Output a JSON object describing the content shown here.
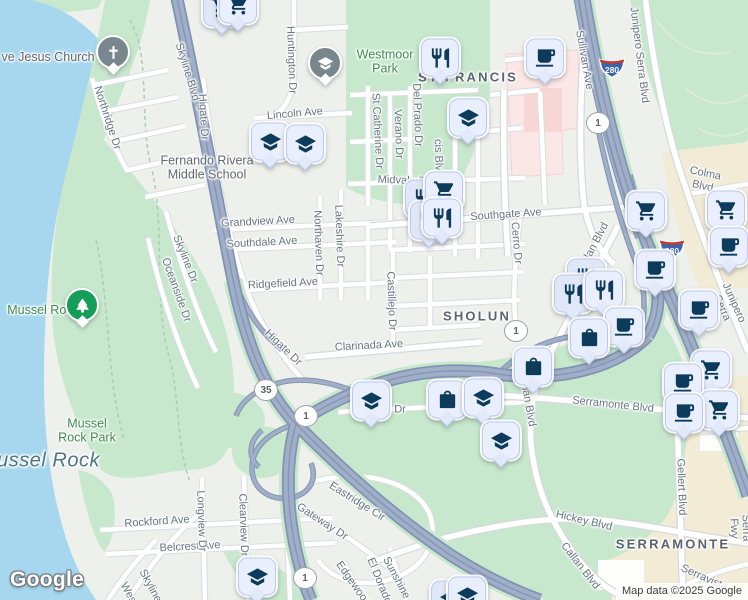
{
  "map": {
    "logo": "Google",
    "attribution": "Map data ©2025 Google",
    "colors": {
      "land": "#eef0ec",
      "water": "#a6d7ef",
      "park": "#c7e8cd",
      "beige": "#f2ecd7",
      "pink": "#fbe7e6",
      "road_fill": "#ffffff",
      "road_casing": "#dadce0",
      "freeway_fill": "#a1aec8",
      "freeway_casing": "#8093b3",
      "pin_bg": "#e9effc",
      "pin_border": "#bcc9ef",
      "pin_icon": "#0d3b5c",
      "circle_pin_gray": "#78868e",
      "circle_pin_green": "#149e57",
      "shield_blue": "#3a64ad",
      "shield_red": "#c63b31",
      "street_label": "#66757f",
      "area_label": "#5a646e",
      "park_label": "#3f8a52",
      "water_label": "#4e7585"
    },
    "labels": [
      {
        "name": "jesus-church",
        "text": "ve Jesus Church",
        "x": 48,
        "y": 57,
        "rot": 0,
        "type": "poi"
      },
      {
        "name": "northridge-dr",
        "text": "Northridge Dr",
        "x": 107,
        "y": 118,
        "rot": 72,
        "type": "street"
      },
      {
        "name": "skyline-blvd",
        "text": "Skyline Blvd",
        "x": 187,
        "y": 72,
        "rot": 73,
        "type": "street"
      },
      {
        "name": "higate-dr-north",
        "text": "Higate Dr",
        "x": 203,
        "y": 117,
        "rot": 87,
        "type": "street"
      },
      {
        "name": "huntington-dr",
        "text": "Huntington Dr",
        "x": 291,
        "y": 60,
        "rot": 88,
        "type": "street"
      },
      {
        "name": "lincoln-ave",
        "text": "Lincoln Ave",
        "x": 295,
        "y": 114,
        "rot": -5,
        "type": "street"
      },
      {
        "name": "fernando-rivera-middle-school",
        "text": "Fernando Rivera\nMiddle School",
        "x": 207,
        "y": 168,
        "rot": 0,
        "type": "poi"
      },
      {
        "name": "westmoor-park",
        "text": "Westmoor\nPark",
        "x": 385,
        "y": 62,
        "rot": 0,
        "type": "park"
      },
      {
        "name": "st-francis",
        "text": "ST FRANCIS",
        "x": 468,
        "y": 78,
        "rot": 0,
        "type": "area"
      },
      {
        "name": "st-catherine-dr",
        "text": "St Catherine Dr",
        "x": 377,
        "y": 131,
        "rot": 87,
        "type": "street"
      },
      {
        "name": "verano-dr",
        "text": "Verano Dr",
        "x": 398,
        "y": 134,
        "rot": 88,
        "type": "street"
      },
      {
        "name": "del-prado-dr",
        "text": "Del Prado Dr",
        "x": 417,
        "y": 115,
        "rot": 88,
        "type": "street"
      },
      {
        "name": "francis-blvd",
        "text": "cis Blvd",
        "x": 438,
        "y": 158,
        "rot": 88,
        "type": "street"
      },
      {
        "name": "sullivan-ave",
        "text": "Sullivan Ave",
        "x": 584,
        "y": 60,
        "rot": 80,
        "type": "street"
      },
      {
        "name": "junipero-serra-blvd-north",
        "text": "Junipero Serra Blvd",
        "x": 639,
        "y": 55,
        "rot": 83,
        "type": "street"
      },
      {
        "name": "colma-blvd",
        "text": "Colma Blvd",
        "x": 704,
        "y": 180,
        "rot": 12,
        "type": "street"
      },
      {
        "name": "midvale-dr",
        "text": "Midvale Dr",
        "x": 404,
        "y": 181,
        "rot": 2,
        "type": "street"
      },
      {
        "name": "grandview-ave",
        "text": "Grandview Ave",
        "x": 258,
        "y": 222,
        "rot": -3,
        "type": "street"
      },
      {
        "name": "southdale-ave",
        "text": "Southdale Ave",
        "x": 262,
        "y": 243,
        "rot": -3,
        "type": "street"
      },
      {
        "name": "northaven-dr",
        "text": "Northaven Dr",
        "x": 318,
        "y": 243,
        "rot": 88,
        "type": "street"
      },
      {
        "name": "lakeshire-dr",
        "text": "Lakeshire Dr",
        "x": 339,
        "y": 236,
        "rot": 88,
        "type": "street"
      },
      {
        "name": "ridgefield-ave",
        "text": "Ridgefield Ave",
        "x": 283,
        "y": 284,
        "rot": -3,
        "type": "street"
      },
      {
        "name": "castillejo-dr",
        "text": "Castillejo Dr",
        "x": 391,
        "y": 301,
        "rot": 88,
        "type": "street"
      },
      {
        "name": "skyline-dr",
        "text": "Skyline Dr",
        "x": 185,
        "y": 259,
        "rot": 68,
        "type": "street"
      },
      {
        "name": "oceanside-dr",
        "text": "Oceanside Dr",
        "x": 176,
        "y": 290,
        "rot": 70,
        "type": "street"
      },
      {
        "name": "higate-dr-south",
        "text": "Higate Dr",
        "x": 283,
        "y": 348,
        "rot": 44,
        "type": "street"
      },
      {
        "name": "clarinada-ave",
        "text": "Clarinada Ave",
        "x": 369,
        "y": 346,
        "rot": -3,
        "type": "street"
      },
      {
        "name": "southgate-ave",
        "text": "Southgate Ave",
        "x": 506,
        "y": 215,
        "rot": -4,
        "type": "street"
      },
      {
        "name": "cerro-dr",
        "text": "Cerro Dr",
        "x": 516,
        "y": 243,
        "rot": 85,
        "type": "street"
      },
      {
        "name": "sholun",
        "text": "SHOLUN",
        "x": 477,
        "y": 317,
        "rot": 0,
        "type": "area"
      },
      {
        "name": "callan-blvd-north",
        "text": "Callan Blvd",
        "x": 593,
        "y": 248,
        "rot": -62,
        "type": "street"
      },
      {
        "name": "mussel-rock-poi",
        "text": "Mussel Rock",
        "x": 43,
        "y": 310,
        "rot": 0,
        "type": "park"
      },
      {
        "name": "mussel-rock-park",
        "text": "Mussel\nRock Park",
        "x": 87,
        "y": 431,
        "rot": 0,
        "type": "park"
      },
      {
        "name": "mussel-rock-water",
        "text": "Mussel Rock",
        "x": 40,
        "y": 461,
        "rot": 0,
        "type": "water"
      },
      {
        "name": "serramonte-blvd",
        "text": "Serramonte Blvd",
        "x": 613,
        "y": 405,
        "rot": 6,
        "type": "street"
      },
      {
        "name": "callan-blvd-mid",
        "text": "Callan Blvd",
        "x": 527,
        "y": 399,
        "rot": 80,
        "type": "street"
      },
      {
        "name": "dr-fragment",
        "text": "Dr",
        "x": 400,
        "y": 410,
        "rot": 0,
        "type": "street"
      },
      {
        "name": "hickey-blvd",
        "text": "Hickey Blvd",
        "x": 584,
        "y": 521,
        "rot": 13,
        "type": "street"
      },
      {
        "name": "callan-blvd-south",
        "text": "Callan Blvd",
        "x": 580,
        "y": 566,
        "rot": 52,
        "type": "street"
      },
      {
        "name": "serramonte-area",
        "text": "SERRAMONTE",
        "x": 673,
        "y": 545,
        "rot": 0,
        "type": "area"
      },
      {
        "name": "gellert-blvd",
        "text": "Gellert Blvd",
        "x": 681,
        "y": 487,
        "rot": 88,
        "type": "street"
      },
      {
        "name": "junipero-serra-fwy",
        "text": "Junipero Serra Fwy",
        "x": 746,
        "y": 528,
        "rot": 88,
        "type": "street"
      },
      {
        "name": "serravista",
        "text": "Serravista",
        "x": 704,
        "y": 578,
        "rot": 24,
        "type": "street"
      },
      {
        "name": "rockford-ave",
        "text": "Rockford Ave",
        "x": 157,
        "y": 522,
        "rot": -4,
        "type": "street"
      },
      {
        "name": "belcrest-ave",
        "text": "Belcrest Ave",
        "x": 190,
        "y": 547,
        "rot": -3,
        "type": "street"
      },
      {
        "name": "longview-dr",
        "text": "Longview Dr",
        "x": 201,
        "y": 521,
        "rot": 88,
        "type": "street"
      },
      {
        "name": "clearview-dr",
        "text": "Clearview Dr",
        "x": 243,
        "y": 525,
        "rot": 88,
        "type": "street"
      },
      {
        "name": "eastridge-cir",
        "text": "Eastridge Cir",
        "x": 357,
        "y": 502,
        "rot": 32,
        "type": "street"
      },
      {
        "name": "gateway-dr",
        "text": "Gateway Dr",
        "x": 322,
        "y": 522,
        "rot": 33,
        "type": "street"
      },
      {
        "name": "sunshine",
        "text": "Sunshine",
        "x": 396,
        "y": 578,
        "rot": 62,
        "type": "street"
      },
      {
        "name": "el-dorado",
        "text": "El Dorado",
        "x": 379,
        "y": 581,
        "rot": 68,
        "type": "street"
      },
      {
        "name": "edgewood",
        "text": "Edgewood",
        "x": 353,
        "y": 584,
        "rot": 55,
        "type": "street"
      },
      {
        "name": "skyline-bottom",
        "text": "Skyline",
        "x": 150,
        "y": 586,
        "rot": 62,
        "type": "street"
      },
      {
        "name": "wes-bottom",
        "text": "Wes",
        "x": 128,
        "y": 593,
        "rot": 62,
        "type": "street"
      },
      {
        "name": "junipero-serra-blvd-mid",
        "text": "Junipero Serra Blvd",
        "x": 722,
        "y": 308,
        "rot": 66,
        "type": "street"
      }
    ],
    "shields": [
      {
        "type": "interstate",
        "text": "280",
        "x": 612,
        "y": 70
      },
      {
        "type": "interstate",
        "text": "280",
        "x": 672,
        "y": 251
      },
      {
        "type": "state",
        "text": "1",
        "x": 598,
        "y": 123
      },
      {
        "type": "state",
        "text": "1",
        "x": 516,
        "y": 331
      },
      {
        "type": "state",
        "text": "35",
        "x": 266,
        "y": 390
      },
      {
        "type": "state",
        "text": "1",
        "x": 306,
        "y": 416
      },
      {
        "type": "state",
        "text": "1",
        "x": 305,
        "y": 578
      }
    ],
    "pins": [
      {
        "icon": "cart",
        "x": 222,
        "y": 14,
        "back": true
      },
      {
        "icon": "cart",
        "x": 238,
        "y": 11
      },
      {
        "icon": "school",
        "x": 325,
        "y": 68,
        "shape": "circle",
        "color": "gray"
      },
      {
        "icon": "grad",
        "x": 270,
        "y": 148
      },
      {
        "icon": "grad",
        "x": 305,
        "y": 150
      },
      {
        "icon": "restaurant",
        "x": 440,
        "y": 64
      },
      {
        "icon": "coffee",
        "x": 545,
        "y": 64
      },
      {
        "icon": "grad",
        "x": 468,
        "y": 124
      },
      {
        "icon": "restaurant",
        "x": 424,
        "y": 205,
        "back": true
      },
      {
        "icon": "cart",
        "x": 444,
        "y": 197
      },
      {
        "icon": "restaurant",
        "x": 429,
        "y": 227,
        "back": true
      },
      {
        "icon": "restaurant",
        "x": 442,
        "y": 224
      },
      {
        "icon": "grad",
        "x": 371,
        "y": 407
      },
      {
        "icon": "bag",
        "x": 447,
        "y": 406
      },
      {
        "icon": "grad",
        "x": 483,
        "y": 404
      },
      {
        "icon": "grad",
        "x": 501,
        "y": 447
      },
      {
        "icon": "cart",
        "x": 646,
        "y": 217
      },
      {
        "icon": "cart",
        "x": 726,
        "y": 216
      },
      {
        "icon": "coffee",
        "x": 729,
        "y": 253
      },
      {
        "icon": "coffee",
        "x": 655,
        "y": 276
      },
      {
        "icon": "restaurant",
        "x": 586,
        "y": 284,
        "back": true
      },
      {
        "icon": "restaurant",
        "x": 573,
        "y": 300,
        "back": true
      },
      {
        "icon": "restaurant",
        "x": 604,
        "y": 296
      },
      {
        "icon": "coffee",
        "x": 624,
        "y": 333
      },
      {
        "icon": "bag",
        "x": 589,
        "y": 344
      },
      {
        "icon": "bag",
        "x": 533,
        "y": 373
      },
      {
        "icon": "coffee",
        "x": 699,
        "y": 316
      },
      {
        "icon": "cart",
        "x": 711,
        "y": 376
      },
      {
        "icon": "coffee",
        "x": 683,
        "y": 389
      },
      {
        "icon": "cart",
        "x": 719,
        "y": 416
      },
      {
        "icon": "coffee",
        "x": 684,
        "y": 419
      },
      {
        "icon": "grad",
        "x": 257,
        "y": 583
      },
      {
        "icon": "grad",
        "x": 450,
        "y": 606,
        "back": true
      },
      {
        "icon": "grad",
        "x": 467,
        "y": 602
      },
      {
        "icon": "church",
        "x": 113,
        "y": 57,
        "shape": "circle",
        "color": "gray"
      },
      {
        "icon": "tree",
        "x": 82,
        "y": 310,
        "shape": "circle",
        "color": "green"
      }
    ]
  }
}
